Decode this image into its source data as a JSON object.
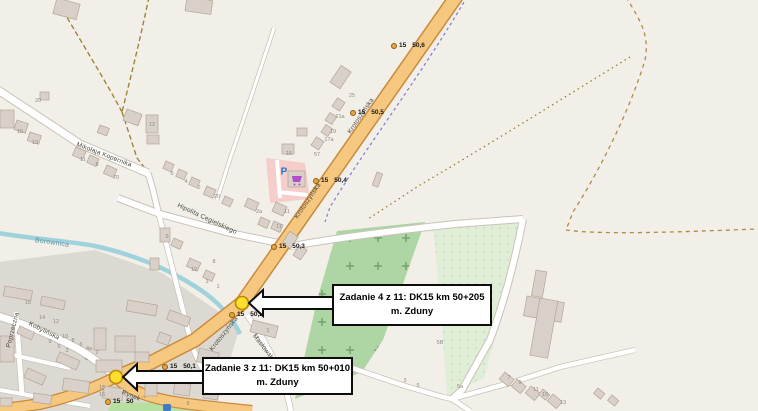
{
  "callouts": [
    {
      "text_line1": "Zadanie 4 z 11: DK15 km 50+205",
      "text_line2": "m. Zduny"
    },
    {
      "text_line1": "Zadanie 3 z 11: DK15 km 50+010",
      "text_line2": "m. Zduny"
    }
  ],
  "milestones": {
    "road_ref": "15",
    "items": [
      {
        "km": "50,6",
        "x": 391,
        "y": 42
      },
      {
        "km": "50,5",
        "x": 350,
        "y": 109
      },
      {
        "km": "50,4",
        "x": 313,
        "y": 177
      },
      {
        "km": "50,3",
        "x": 271,
        "y": 243
      },
      {
        "km": "50,2",
        "x": 229,
        "y": 311
      },
      {
        "km": "50,1",
        "x": 162,
        "y": 363
      },
      {
        "km": "50",
        "x": 105,
        "y": 398
      }
    ]
  },
  "streets": [
    {
      "name": "Mikołaja Kopernika",
      "x": 104,
      "y": 155,
      "rot": 21
    },
    {
      "name": "Hipolita Cegielskiego",
      "x": 207,
      "y": 219,
      "rot": 25
    },
    {
      "name": "Krotoszyńska",
      "x": 361,
      "y": 116,
      "rot": -56
    },
    {
      "name": "Krotoszyńska",
      "x": 308,
      "y": 201,
      "rot": -56
    },
    {
      "name": "Krotoszyńska",
      "x": 224,
      "y": 334,
      "rot": -52
    },
    {
      "name": "Kobylińska",
      "x": 44,
      "y": 331,
      "rot": 26
    },
    {
      "name": "Poprzeczna",
      "x": 13,
      "y": 330,
      "rot": -76
    },
    {
      "name": "Rynek",
      "x": 131,
      "y": 396,
      "rot": 21
    },
    {
      "name": "Masłowskiego",
      "x": 267,
      "y": 352,
      "rot": 52
    }
  ],
  "waterway": {
    "name": "Borownica"
  },
  "poi": {
    "parking_label": "P",
    "supermarket_icon": "shopping-cart",
    "bus_stop_icon": "bus"
  },
  "icons": {
    "oneway_arrow": "→"
  },
  "house_numbers": [
    {
      "t": "20",
      "x": 38,
      "y": 101
    },
    {
      "t": "15",
      "x": 20,
      "y": 132
    },
    {
      "t": "13",
      "x": 35,
      "y": 143
    },
    {
      "t": "11",
      "x": 83,
      "y": 160
    },
    {
      "t": "9",
      "x": 97,
      "y": 165
    },
    {
      "t": "70",
      "x": 116,
      "y": 178
    },
    {
      "t": "12",
      "x": 152,
      "y": 125
    },
    {
      "t": "6",
      "x": 172,
      "y": 174
    },
    {
      "t": "4",
      "x": 186,
      "y": 182
    },
    {
      "t": "2",
      "x": 199,
      "y": 188
    },
    {
      "t": "20",
      "x": 217,
      "y": 197
    },
    {
      "t": "25",
      "x": 352,
      "y": 96
    },
    {
      "t": "21a",
      "x": 340,
      "y": 117
    },
    {
      "t": "19",
      "x": 333,
      "y": 132
    },
    {
      "t": "17a",
      "x": 329,
      "y": 140
    },
    {
      "t": "57",
      "x": 317,
      "y": 155
    },
    {
      "t": "15",
      "x": 289,
      "y": 154
    },
    {
      "t": "2a",
      "x": 259,
      "y": 212
    },
    {
      "t": "11",
      "x": 287,
      "y": 212
    },
    {
      "t": "11",
      "x": 279,
      "y": 227
    },
    {
      "t": "1",
      "x": 268,
      "y": 331
    },
    {
      "t": "5",
      "x": 167,
      "y": 237
    },
    {
      "t": "12",
      "x": 194,
      "y": 270
    },
    {
      "t": "8",
      "x": 214,
      "y": 262
    },
    {
      "t": "3",
      "x": 207,
      "y": 282
    },
    {
      "t": "1",
      "x": 218,
      "y": 287
    },
    {
      "t": "16",
      "x": 28,
      "y": 303
    },
    {
      "t": "14",
      "x": 42,
      "y": 318
    },
    {
      "t": "12",
      "x": 56,
      "y": 322
    },
    {
      "t": "10",
      "x": 65,
      "y": 337
    },
    {
      "t": "8",
      "x": 73,
      "y": 341
    },
    {
      "t": "6",
      "x": 81,
      "y": 345
    },
    {
      "t": "4a",
      "x": 89,
      "y": 349
    },
    {
      "t": "2",
      "x": 97,
      "y": 353
    },
    {
      "t": "9",
      "x": 50,
      "y": 342
    },
    {
      "t": "5",
      "x": 59,
      "y": 347
    },
    {
      "t": "3",
      "x": 67,
      "y": 351
    },
    {
      "t": "15",
      "x": 102,
      "y": 388
    },
    {
      "t": "16",
      "x": 102,
      "y": 395
    },
    {
      "t": "8",
      "x": 188,
      "y": 404
    },
    {
      "t": "7",
      "x": 509,
      "y": 378
    },
    {
      "t": "9",
      "x": 520,
      "y": 383
    },
    {
      "t": "11",
      "x": 536,
      "y": 390
    },
    {
      "t": "15",
      "x": 545,
      "y": 395
    },
    {
      "t": "13",
      "x": 563,
      "y": 403
    },
    {
      "t": "5B",
      "x": 440,
      "y": 343
    },
    {
      "t": "5a",
      "x": 460,
      "y": 387
    },
    {
      "t": "3",
      "x": 405,
      "y": 381
    },
    {
      "t": "5",
      "x": 418,
      "y": 386
    }
  ],
  "palette": {
    "background": "#f2efe8",
    "urban_area": "#dcd9d3",
    "main_road_fill": "#f6c77f",
    "main_road_casing": "#c98a3c",
    "minor_road_fill": "#ffffff",
    "minor_road_casing": "#c9c2b8",
    "stream": "#a0d2dd",
    "orchard": "#aed6a4",
    "field": "#e0eed7",
    "park": "#b7dfa2",
    "parking_area": "#f5cdc9",
    "building_fill": "#d9d0c9",
    "building_stroke": "#b3a593",
    "marker_yellow": "#ffdf2b",
    "callout_border": "#0d0d0d",
    "cycleway_blue": "#7b7bd8",
    "track_dashed": "#9a7d2e"
  }
}
